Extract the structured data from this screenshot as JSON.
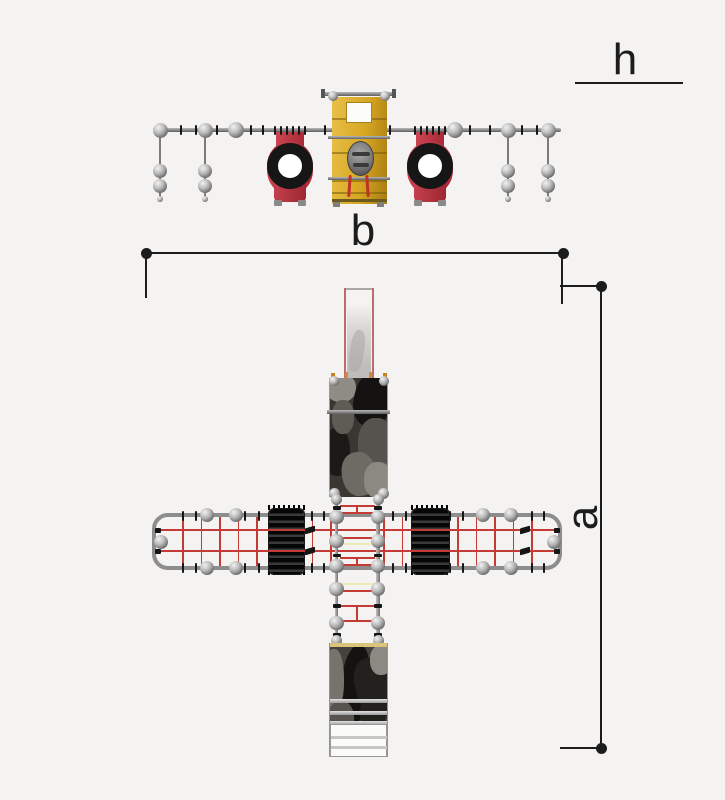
{
  "labels": {
    "h": "h",
    "b": "b",
    "a": "a"
  },
  "colors": {
    "background": "#f4f3f1",
    "dimension_line": "#1c1c1c",
    "steel_gray": "#8d8d8d",
    "net_red": "#c43a35",
    "rung_yellow": "#efe9b6",
    "climber_red": "#b8303e",
    "ring_black": "#161616",
    "tower_yellow": "#d8a722",
    "slide_rail_pink": "#bf6a6e",
    "platform_camo_dark": "#3a3733"
  }
}
